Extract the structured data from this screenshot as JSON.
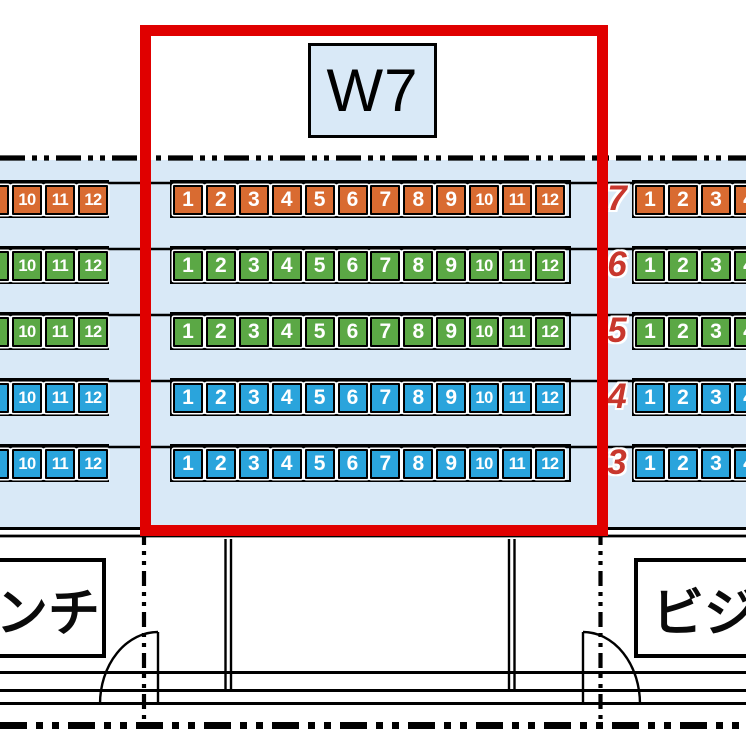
{
  "section": {
    "label": "W7"
  },
  "rows": [
    {
      "label": "7",
      "color_key": "orange",
      "left_seats": [
        "9",
        "10",
        "11",
        "12"
      ],
      "middle_seats": [
        "1",
        "2",
        "3",
        "4",
        "5",
        "6",
        "7",
        "8",
        "9",
        "10",
        "11",
        "12"
      ],
      "right_seats": [
        "1",
        "2",
        "3",
        "4"
      ]
    },
    {
      "label": "6",
      "color_key": "green",
      "left_seats": [
        "9",
        "10",
        "11",
        "12"
      ],
      "middle_seats": [
        "1",
        "2",
        "3",
        "4",
        "5",
        "6",
        "7",
        "8",
        "9",
        "10",
        "11",
        "12"
      ],
      "right_seats": [
        "1",
        "2",
        "3",
        "4"
      ]
    },
    {
      "label": "5",
      "color_key": "green",
      "left_seats": [
        "9",
        "10",
        "11",
        "12"
      ],
      "middle_seats": [
        "1",
        "2",
        "3",
        "4",
        "5",
        "6",
        "7",
        "8",
        "9",
        "10",
        "11",
        "12"
      ],
      "right_seats": [
        "1",
        "2",
        "3",
        "4"
      ]
    },
    {
      "label": "4",
      "color_key": "blue",
      "left_seats": [
        "9",
        "10",
        "11",
        "12"
      ],
      "middle_seats": [
        "1",
        "2",
        "3",
        "4",
        "5",
        "6",
        "7",
        "8",
        "9",
        "10",
        "11",
        "12"
      ],
      "right_seats": [
        "1",
        "2",
        "3",
        "4"
      ]
    },
    {
      "label": "3",
      "color_key": "blue",
      "left_seats": [
        "9",
        "10",
        "11",
        "12"
      ],
      "middle_seats": [
        "1",
        "2",
        "3",
        "4",
        "5",
        "6",
        "7",
        "8",
        "9",
        "10",
        "11",
        "12"
      ],
      "right_seats": [
        "1",
        "2",
        "3",
        "4"
      ]
    }
  ],
  "dugout": {
    "bench_label": "ベンチ",
    "visitor_label": "ビジター"
  },
  "colors": {
    "field": "#D9E9F7",
    "orange": "#D96B31",
    "green": "#5BA845",
    "blue": "#2AA4DC",
    "highlight": "#E00000",
    "row_number": "#C8372D"
  }
}
